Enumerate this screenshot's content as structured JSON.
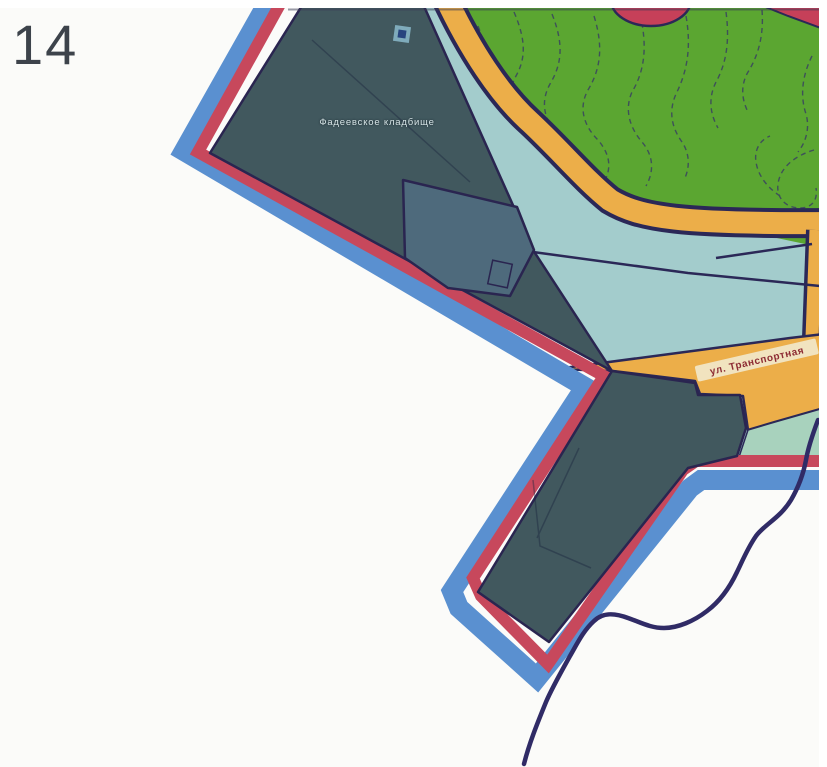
{
  "page": {
    "number": "14"
  },
  "map": {
    "labels": {
      "cemetery": "Фадеевское кладбище",
      "street": "ул. Транспортная"
    },
    "legend_semantics": {
      "blue_band": "site-boundary-outer-band",
      "red_band": "site-boundary-inner-band",
      "slate_area": "cemetery-territory",
      "green_area": "park-vegetation-with-contours",
      "orange_band": "road",
      "teal_area": "open-land",
      "navy_curve": "stream"
    },
    "colors": {
      "paper": "#fbfbf9",
      "boundary_outer_blue": "#5a90d0",
      "boundary_inner_red": "#c7485c",
      "cemetery_fill": "#41585e",
      "building_fill": "#4e6a7c",
      "vegetation_green": "#5ba631",
      "road_orange": "#ecae49",
      "road_casing_navy": "#2b2857",
      "open_land_teal": "#a3cccc",
      "open_land_light_green": "#a8d2bd",
      "stream_navy": "#302b66",
      "accent_crimson": "#c64059",
      "ribbon_cream": "#f1e6c6",
      "page_number_gray": "#3d434b"
    }
  }
}
